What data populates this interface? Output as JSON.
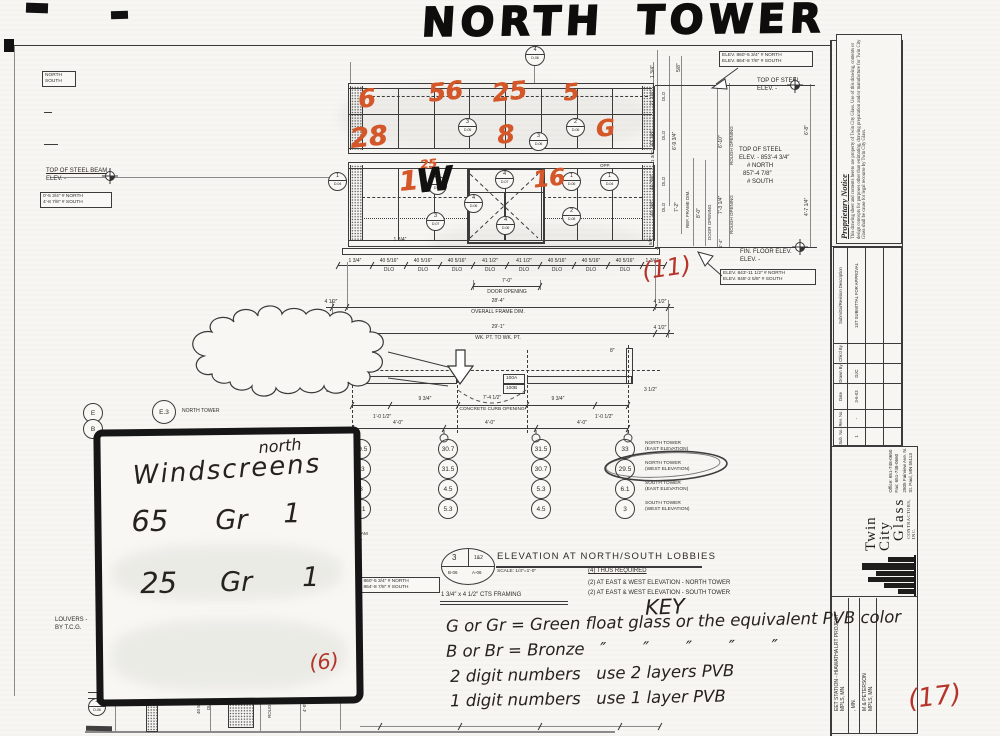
{
  "colors": {
    "ink": "#2e2b28",
    "line": "#3b3b3b",
    "orange": "#d4572a",
    "red": "#b5342a",
    "paper": "#f7f6f2"
  },
  "title": "NORTH TOWER",
  "key": {
    "title": "KEY",
    "line1": "G or Gr = Green float glass or the equivalent PVB color",
    "line2": "B or Br = Bronze   ″       ″       ″       ″       ″",
    "line3": "2 digit numbers   use 2 layers PVB",
    "line4": "1 digit numbers   use 1 layer PVB"
  },
  "windscreens": {
    "corner": "north",
    "title": "Windscreens",
    "rows": [
      {
        "qty": "65",
        "glass": "Gr",
        "layers": "1"
      },
      {
        "qty": "25",
        "glass": "Gr",
        "layers": "1"
      }
    ],
    "count": "(6)"
  },
  "red_marks": [
    {
      "n": "count-11",
      "t": "(11)",
      "x": 642,
      "y": 254,
      "fs": 24,
      "rot": -8
    },
    {
      "n": "count-6",
      "t": "(6)",
      "x": 206,
      "y": 216,
      "fs": 21,
      "rot": -5,
      "inbox": true
    },
    {
      "n": "count-17",
      "t": "(17)",
      "x": 908,
      "y": 682,
      "fs": 26,
      "rot": -7
    }
  ],
  "glass_marks": [
    {
      "t": "6",
      "x": 358,
      "y": 84,
      "fs": 25
    },
    {
      "t": "56",
      "x": 428,
      "y": 77,
      "fs": 25
    },
    {
      "t": "25",
      "x": 492,
      "y": 77,
      "fs": 25
    },
    {
      "t": "5",
      "x": 563,
      "y": 80,
      "fs": 23
    },
    {
      "t": "28",
      "x": 350,
      "y": 122,
      "fs": 27
    },
    {
      "t": "8",
      "x": 497,
      "y": 120,
      "fs": 25
    },
    {
      "t": "G",
      "x": 596,
      "y": 116,
      "fs": 23
    },
    {
      "t": "1",
      "x": 399,
      "y": 166,
      "fs": 27
    },
    {
      "t": "25",
      "x": 420,
      "y": 157,
      "fs": 12
    },
    {
      "t": "16",
      "x": 533,
      "y": 166,
      "fs": 23
    }
  ],
  "w_mark": {
    "t": "W",
    "x": 416,
    "y": 160,
    "fs": 33
  },
  "cloud_note": {
    "heading": "ARCHITECT/G.C. NOTE:",
    "lines": [
      "CONCRETE CURB OPENING IS TO",
      "BE 7'-4 1/2″. PLEASE NOTE, THIS",
      "DEVIATES FROM THE 7'-4″ DIMENSION",
      "CALLED OUT ON STRUCTURAL DRG.'S",
      "S-02 & S-10. PLEASE COORDINATE",
      "ACCORDINGLY."
    ]
  },
  "lobby": {
    "q1": "3",
    "q2": "1&2",
    "q3": "B-06",
    "q4": "A-06",
    "title": "ELEVATION AT NORTH/SOUTH LOBBIES",
    "scale": "SCALE: 1/4″=1'-0″",
    "framing": "1 3/4″ x 4 1/2″ CTS FRAMING",
    "req1": "(4) THUS REQUIRED",
    "req2": "(2) AT EAST & WEST ELEVATION - NORTH TOWER",
    "req3": "(2) AT EAST & WEST ELEVATION - SOUTH TOWER"
  },
  "schedule": {
    "col_x": [
      360,
      447,
      540,
      624
    ],
    "row_y": [
      448,
      468,
      488,
      508
    ],
    "columns": [
      [
        "29.5",
        "33",
        "3",
        "6.1"
      ],
      [
        "30.7",
        "31.5",
        "4.5",
        "5.3"
      ],
      [
        "31.5",
        "30.7",
        "5.3",
        "4.5"
      ],
      [
        "33",
        "29.5",
        "6.1",
        "3"
      ]
    ],
    "labels": [
      [
        "NORTH TOWER",
        "(EAST ELEVATION)"
      ],
      [
        "NORTH TOWER",
        "(WEST ELEVATION)"
      ],
      [
        "SOUTH TOWER",
        "(EAST ELEVATION)"
      ],
      [
        "SOUTH TOWER",
        "(WEST ELEVATION)"
      ]
    ],
    "label_x": 645
  },
  "grid_circles": [
    {
      "t": "E",
      "x": 83,
      "y": 403,
      "d": 18
    },
    {
      "t": "B",
      "x": 83,
      "y": 419,
      "d": 18
    },
    {
      "t": "E.3",
      "x": 152,
      "y": 400,
      "d": 22
    }
  ],
  "bubbles": [
    {
      "n": "4",
      "s": "D-06",
      "x": 525,
      "y": 46,
      "d": 18
    },
    {
      "n": "3",
      "s": "D-05",
      "x": 458,
      "y": 118,
      "d": 17
    },
    {
      "n": "2",
      "s": "D-06",
      "x": 566,
      "y": 118,
      "d": 17
    },
    {
      "n": "3",
      "s": "D-06",
      "x": 529,
      "y": 132,
      "d": 17
    },
    {
      "n": "1",
      "s": "D-04",
      "x": 328,
      "y": 172,
      "d": 17
    },
    {
      "n": "3",
      "s": "D-07",
      "x": 428,
      "y": 176,
      "d": 17
    },
    {
      "n": "4",
      "s": "D-07",
      "x": 495,
      "y": 170,
      "d": 17
    },
    {
      "n": "4",
      "s": "D-06",
      "x": 464,
      "y": 194,
      "d": 17
    },
    {
      "n": "4",
      "s": "D-06",
      "x": 496,
      "y": 216,
      "d": 17
    },
    {
      "n": "3",
      "s": "D-07",
      "x": 426,
      "y": 212,
      "d": 17
    },
    {
      "n": "1",
      "s": "D-06",
      "x": 562,
      "y": 172,
      "d": 17
    },
    {
      "n": "2",
      "s": "D-08",
      "x": 562,
      "y": 207,
      "d": 17
    },
    {
      "n": "1",
      "s": "D-04",
      "x": 600,
      "y": 172,
      "d": 17
    },
    {
      "n": "4",
      "s": "D-06",
      "x": 88,
      "y": 698,
      "d": 16
    }
  ],
  "boxes": [
    {
      "n": "north-south-tag",
      "lines": [
        "NORTH",
        "SOUTH"
      ],
      "x": 42,
      "y": 71,
      "w": 28
    },
    {
      "n": "left-elev-box",
      "lines": [
        "0'-5 3/4″ # NORTH",
        "4'-8 7/8″ # SOUTH"
      ],
      "x": 40,
      "y": 192,
      "w": 66
    },
    {
      "n": "top-right-elev-box",
      "lines": [
        "ELEV. 860'-5 3/4″ # NORTH",
        "ELEV. 864'-8 7/8″ # SOUTH"
      ],
      "x": 719,
      "y": 51,
      "w": 88
    },
    {
      "n": "floor-elev-box",
      "lines": [
        "ELEV. 843'-11 1/2″ # NORTH",
        "ELEV. 848'-2 5/8″ # SOUTH"
      ],
      "x": 720,
      "y": 269,
      "w": 90
    },
    {
      "n": "beam-elev-box",
      "lines": [
        "ELEV. 860'-5 3/4″ # NORTH",
        "ELEV. 864'-8 7/8″ # SOUTH"
      ],
      "x": 346,
      "y": 577,
      "w": 88
    },
    {
      "n": "door-tag-100a",
      "lines": [
        "100A"
      ],
      "x": 503,
      "y": 374,
      "w": 16
    },
    {
      "n": "door-tag-100b",
      "lines": [
        "100B"
      ],
      "x": 503,
      "y": 384,
      "w": 16
    }
  ],
  "labels": [
    {
      "n": "top-of-steel-right-1",
      "t": "TOP OF STEEL",
      "x": 757,
      "y": 78,
      "cls": "d"
    },
    {
      "n": "top-of-steel-right-2",
      "t": "ELEV. -",
      "x": 757,
      "y": 86,
      "cls": "d"
    },
    {
      "n": "left-steel-beam-1",
      "t": "TOP OF STEEL BEAM",
      "x": 46,
      "y": 168,
      "cls": "d u"
    },
    {
      "n": "left-steel-beam-2",
      "t": "ELEV. -",
      "x": 46,
      "y": 176,
      "cls": "d"
    },
    {
      "n": "louvers-note-1",
      "t": "LOUVERS -",
      "x": 55,
      "y": 617,
      "cls": "d"
    },
    {
      "n": "louvers-note-2",
      "t": "BY T.C.G.",
      "x": 55,
      "y": 625,
      "cls": "d"
    },
    {
      "n": "fin-floor-1",
      "t": "FIN. FLOOR ELEV.",
      "x": 740,
      "y": 249,
      "cls": "d"
    },
    {
      "n": "fin-floor-2",
      "t": "ELEV. -",
      "x": 740,
      "y": 257,
      "cls": "d"
    },
    {
      "n": "mid-steel-1",
      "t": "TOP OF STEEL",
      "x": 739,
      "y": 147,
      "cls": "d"
    },
    {
      "n": "mid-steel-2",
      "t": "ELEV. - 853'-4 3/4″",
      "x": 739,
      "y": 155,
      "cls": "d"
    },
    {
      "n": "mid-steel-3",
      "t": "# NORTH",
      "x": 747,
      "y": 163,
      "cls": "d"
    },
    {
      "n": "mid-steel-4",
      "t": "857'-4 7/8″",
      "x": 743,
      "y": 171,
      "cls": "d"
    },
    {
      "n": "mid-steel-5",
      "t": "# SOUTH",
      "x": 747,
      "y": 179,
      "cls": "d"
    },
    {
      "n": "opp-label",
      "t": "OPP.",
      "x": 600,
      "y": 163,
      "cls": "d45"
    },
    {
      "n": "grid-label-north-tower",
      "t": "NORTH TOWER",
      "x": 182,
      "y": 408,
      "cls": "d5"
    },
    {
      "t": "1 3/4″",
      "x": 355,
      "y": 258,
      "cls": "c"
    },
    {
      "t": "40 5/16″",
      "x": 389,
      "y": 258,
      "cls": "c"
    },
    {
      "t": "40 5/16″",
      "x": 423,
      "y": 258,
      "cls": "c"
    },
    {
      "t": "40 5/16″",
      "x": 457,
      "y": 258,
      "cls": "c"
    },
    {
      "t": "41 1/2″",
      "x": 490,
      "y": 258,
      "cls": "c"
    },
    {
      "t": "41 1/2″",
      "x": 524,
      "y": 258,
      "cls": "c"
    },
    {
      "t": "40 5/16″",
      "x": 557,
      "y": 258,
      "cls": "c"
    },
    {
      "t": "40 5/16″",
      "x": 591,
      "y": 258,
      "cls": "c"
    },
    {
      "t": "40 5/16″",
      "x": 625,
      "y": 258,
      "cls": "c"
    },
    {
      "t": "1 3/4″",
      "x": 652,
      "y": 258,
      "cls": "c"
    },
    {
      "t": "DLO",
      "x": 389,
      "y": 267,
      "cls": "c"
    },
    {
      "t": "DLO",
      "x": 423,
      "y": 267,
      "cls": "c"
    },
    {
      "t": "DLO",
      "x": 457,
      "y": 267,
      "cls": "c"
    },
    {
      "t": "DLO",
      "x": 490,
      "y": 267,
      "cls": "c"
    },
    {
      "t": "DLO",
      "x": 524,
      "y": 267,
      "cls": "c"
    },
    {
      "t": "DLO",
      "x": 557,
      "y": 267,
      "cls": "c"
    },
    {
      "t": "DLO",
      "x": 591,
      "y": 267,
      "cls": "c"
    },
    {
      "t": "DLO",
      "x": 625,
      "y": 267,
      "cls": "c"
    },
    {
      "t": "7'-0″",
      "x": 507,
      "y": 278,
      "cls": "c"
    },
    {
      "t": "DOOR OPENING",
      "x": 507,
      "y": 289,
      "cls": "c"
    },
    {
      "t": "4 1/2″",
      "x": 331,
      "y": 299,
      "cls": "c"
    },
    {
      "t": "28'-4″",
      "x": 498,
      "y": 298,
      "cls": "c"
    },
    {
      "t": "4 1/2″",
      "x": 660,
      "y": 299,
      "cls": "c"
    },
    {
      "t": "OVERALL FRAME DIM.",
      "x": 498,
      "y": 309,
      "cls": "c"
    },
    {
      "t": "4 1/2″",
      "x": 331,
      "y": 325,
      "cls": "c"
    },
    {
      "t": "29'-1″",
      "x": 498,
      "y": 324,
      "cls": "c"
    },
    {
      "t": "WK. PT. TO WK. PT.",
      "x": 498,
      "y": 335,
      "cls": "c"
    },
    {
      "t": "4 1/2″",
      "x": 660,
      "y": 325,
      "cls": "c"
    },
    {
      "t": "1 3/4″",
      "x": 400,
      "y": 237,
      "cls": "c"
    },
    {
      "t": "8″",
      "x": 366,
      "y": 348,
      "cls": "d5"
    },
    {
      "t": "8″",
      "x": 610,
      "y": 348,
      "cls": "d5"
    },
    {
      "t": "9 3/4″",
      "x": 425,
      "y": 396,
      "cls": "c"
    },
    {
      "t": "7'-4 1/2″",
      "x": 492,
      "y": 395,
      "cls": "c"
    },
    {
      "t": "9 3/4″",
      "x": 558,
      "y": 396,
      "cls": "c"
    },
    {
      "t": "CONCRETE CURB OPENING",
      "x": 492,
      "y": 407,
      "cls": "c",
      "fs": 4.8
    },
    {
      "t": "1'-0 1/2″",
      "x": 382,
      "y": 414,
      "cls": "c"
    },
    {
      "t": "1'-0 1/2″",
      "x": 604,
      "y": 414,
      "cls": "c"
    },
    {
      "t": "4'-0″",
      "x": 398,
      "y": 420,
      "cls": "c"
    },
    {
      "t": "4'-0″",
      "x": 490,
      "y": 420,
      "cls": "c"
    },
    {
      "t": "4'-0″",
      "x": 582,
      "y": 420,
      "cls": "c"
    },
    {
      "t": "3 1/2″",
      "x": 326,
      "y": 388,
      "cls": "d5"
    },
    {
      "t": "3 1/2″",
      "x": 644,
      "y": 387,
      "cls": "d5"
    },
    {
      "n": "frag-el-beam",
      "t": "EL. BEAM",
      "x": 347,
      "y": 531,
      "cls": "d45"
    },
    {
      "n": "frag-dim-1",
      "t": "-4 3/4″",
      "x": 349,
      "y": 538,
      "cls": "d45"
    },
    {
      "n": "frag-north",
      "t": "ORTH",
      "x": 350,
      "y": 640,
      "cls": "d45"
    },
    {
      "n": "frag-dim-2",
      "t": "-4 7/8″",
      "x": 349,
      "y": 647,
      "cls": "d45"
    },
    {
      "n": "frag-south",
      "t": "OUTH",
      "x": 350,
      "y": 654,
      "cls": "d45"
    },
    {
      "t": "1 3/4″",
      "x": 650,
      "y": 78,
      "cls": "r"
    },
    {
      "t": "5/8″",
      "x": 676,
      "y": 72,
      "cls": "r"
    },
    {
      "t": "27 1/8″",
      "x": 650,
      "y": 106,
      "cls": "r"
    },
    {
      "t": "DLO",
      "x": 661,
      "y": 101,
      "cls": "r r45"
    },
    {
      "t": "41 3/8″",
      "x": 650,
      "y": 146,
      "cls": "r"
    },
    {
      "t": "DLO",
      "x": 661,
      "y": 140,
      "cls": "r r45"
    },
    {
      "t": "1 3/4″",
      "x": 650,
      "y": 162,
      "cls": "r r45"
    },
    {
      "t": "40 3/8″",
      "x": 650,
      "y": 190,
      "cls": "r"
    },
    {
      "t": "DLO",
      "x": 661,
      "y": 186,
      "cls": "r r45"
    },
    {
      "t": "40 3/8″",
      "x": 650,
      "y": 216,
      "cls": "r"
    },
    {
      "t": "DLO",
      "x": 661,
      "y": 212,
      "cls": "r r45"
    },
    {
      "t": "6'-9 3/4″",
      "x": 672,
      "y": 150,
      "cls": "r"
    },
    {
      "t": "6'-10″",
      "x": 718,
      "y": 148,
      "cls": "r"
    },
    {
      "t": "ROUGH OPENING",
      "x": 729,
      "y": 165,
      "cls": "r r45"
    },
    {
      "t": "6'-8″",
      "x": 804,
      "y": 135,
      "cls": "r"
    },
    {
      "t": "7'-2″",
      "x": 674,
      "y": 212,
      "cls": "r"
    },
    {
      "t": "REF. FRAME DIM.",
      "x": 685,
      "y": 228,
      "cls": "r r45"
    },
    {
      "t": "8'-0″",
      "x": 696,
      "y": 218,
      "cls": "r"
    },
    {
      "t": "DOOR OPENING",
      "x": 707,
      "y": 240,
      "cls": "r r45"
    },
    {
      "t": "7'-3 1/4″",
      "x": 718,
      "y": 214,
      "cls": "r"
    },
    {
      "t": "ROUGH OPENING",
      "x": 729,
      "y": 234,
      "cls": "r r45"
    },
    {
      "t": "4'-7 1/4″",
      "x": 804,
      "y": 216,
      "cls": "r"
    },
    {
      "t": "5/8″",
      "x": 648,
      "y": 245,
      "cls": "r r45"
    },
    {
      "t": "1'-4″",
      "x": 718,
      "y": 248,
      "cls": "r r45"
    },
    {
      "t": "40 5/16″",
      "x": 196,
      "y": 714,
      "cls": "r r45"
    },
    {
      "t": "DLO",
      "x": 206,
      "y": 710,
      "cls": "r r45"
    },
    {
      "t": "ROUGH OP",
      "x": 267,
      "y": 718,
      "cls": "r r45"
    },
    {
      "t": "4'-0″",
      "x": 302,
      "y": 712,
      "cls": "r r45"
    }
  ],
  "titleblock": {
    "proprietary": {
      "title": "Proprietary Notice",
      "body": "This drawing sheet and contents hereto are property of Twin City Glass. Use of this drawing, contents or design concepts for purposes other than estimating, drawing preparation and/or manufacture for Twin City Glass shall be cause for legal recourse by Twin City Glass."
    },
    "rev_headers": [
      "Sub. No.",
      "Rev. No.",
      "Date",
      "Drawn By",
      "Chk'd By",
      "Submittal/Revision Description"
    ],
    "rev_row": [
      "1",
      "-",
      "3-6-03",
      "DJC",
      "",
      "1ST SUBMITTAL FOR APPROVAL"
    ],
    "company": {
      "name1": "Twin City",
      "name2": "Glass",
      "name3": "CONTRACTORS, INC.",
      "addr1": "2805 Fairview Ave. N.",
      "addr2": "St. Paul, MN 55113",
      "phone1": "Office: 651-748-0650",
      "phone2": "Fax:    651-748-0660"
    },
    "project": {
      "line1": "EET STATION - HIAWATHA LRT PROJECT",
      "line2": "MPLS, MN.",
      "f2": ", MN.",
      "f3": "M & PETERSON",
      "f4": "MPLS, MN."
    }
  }
}
